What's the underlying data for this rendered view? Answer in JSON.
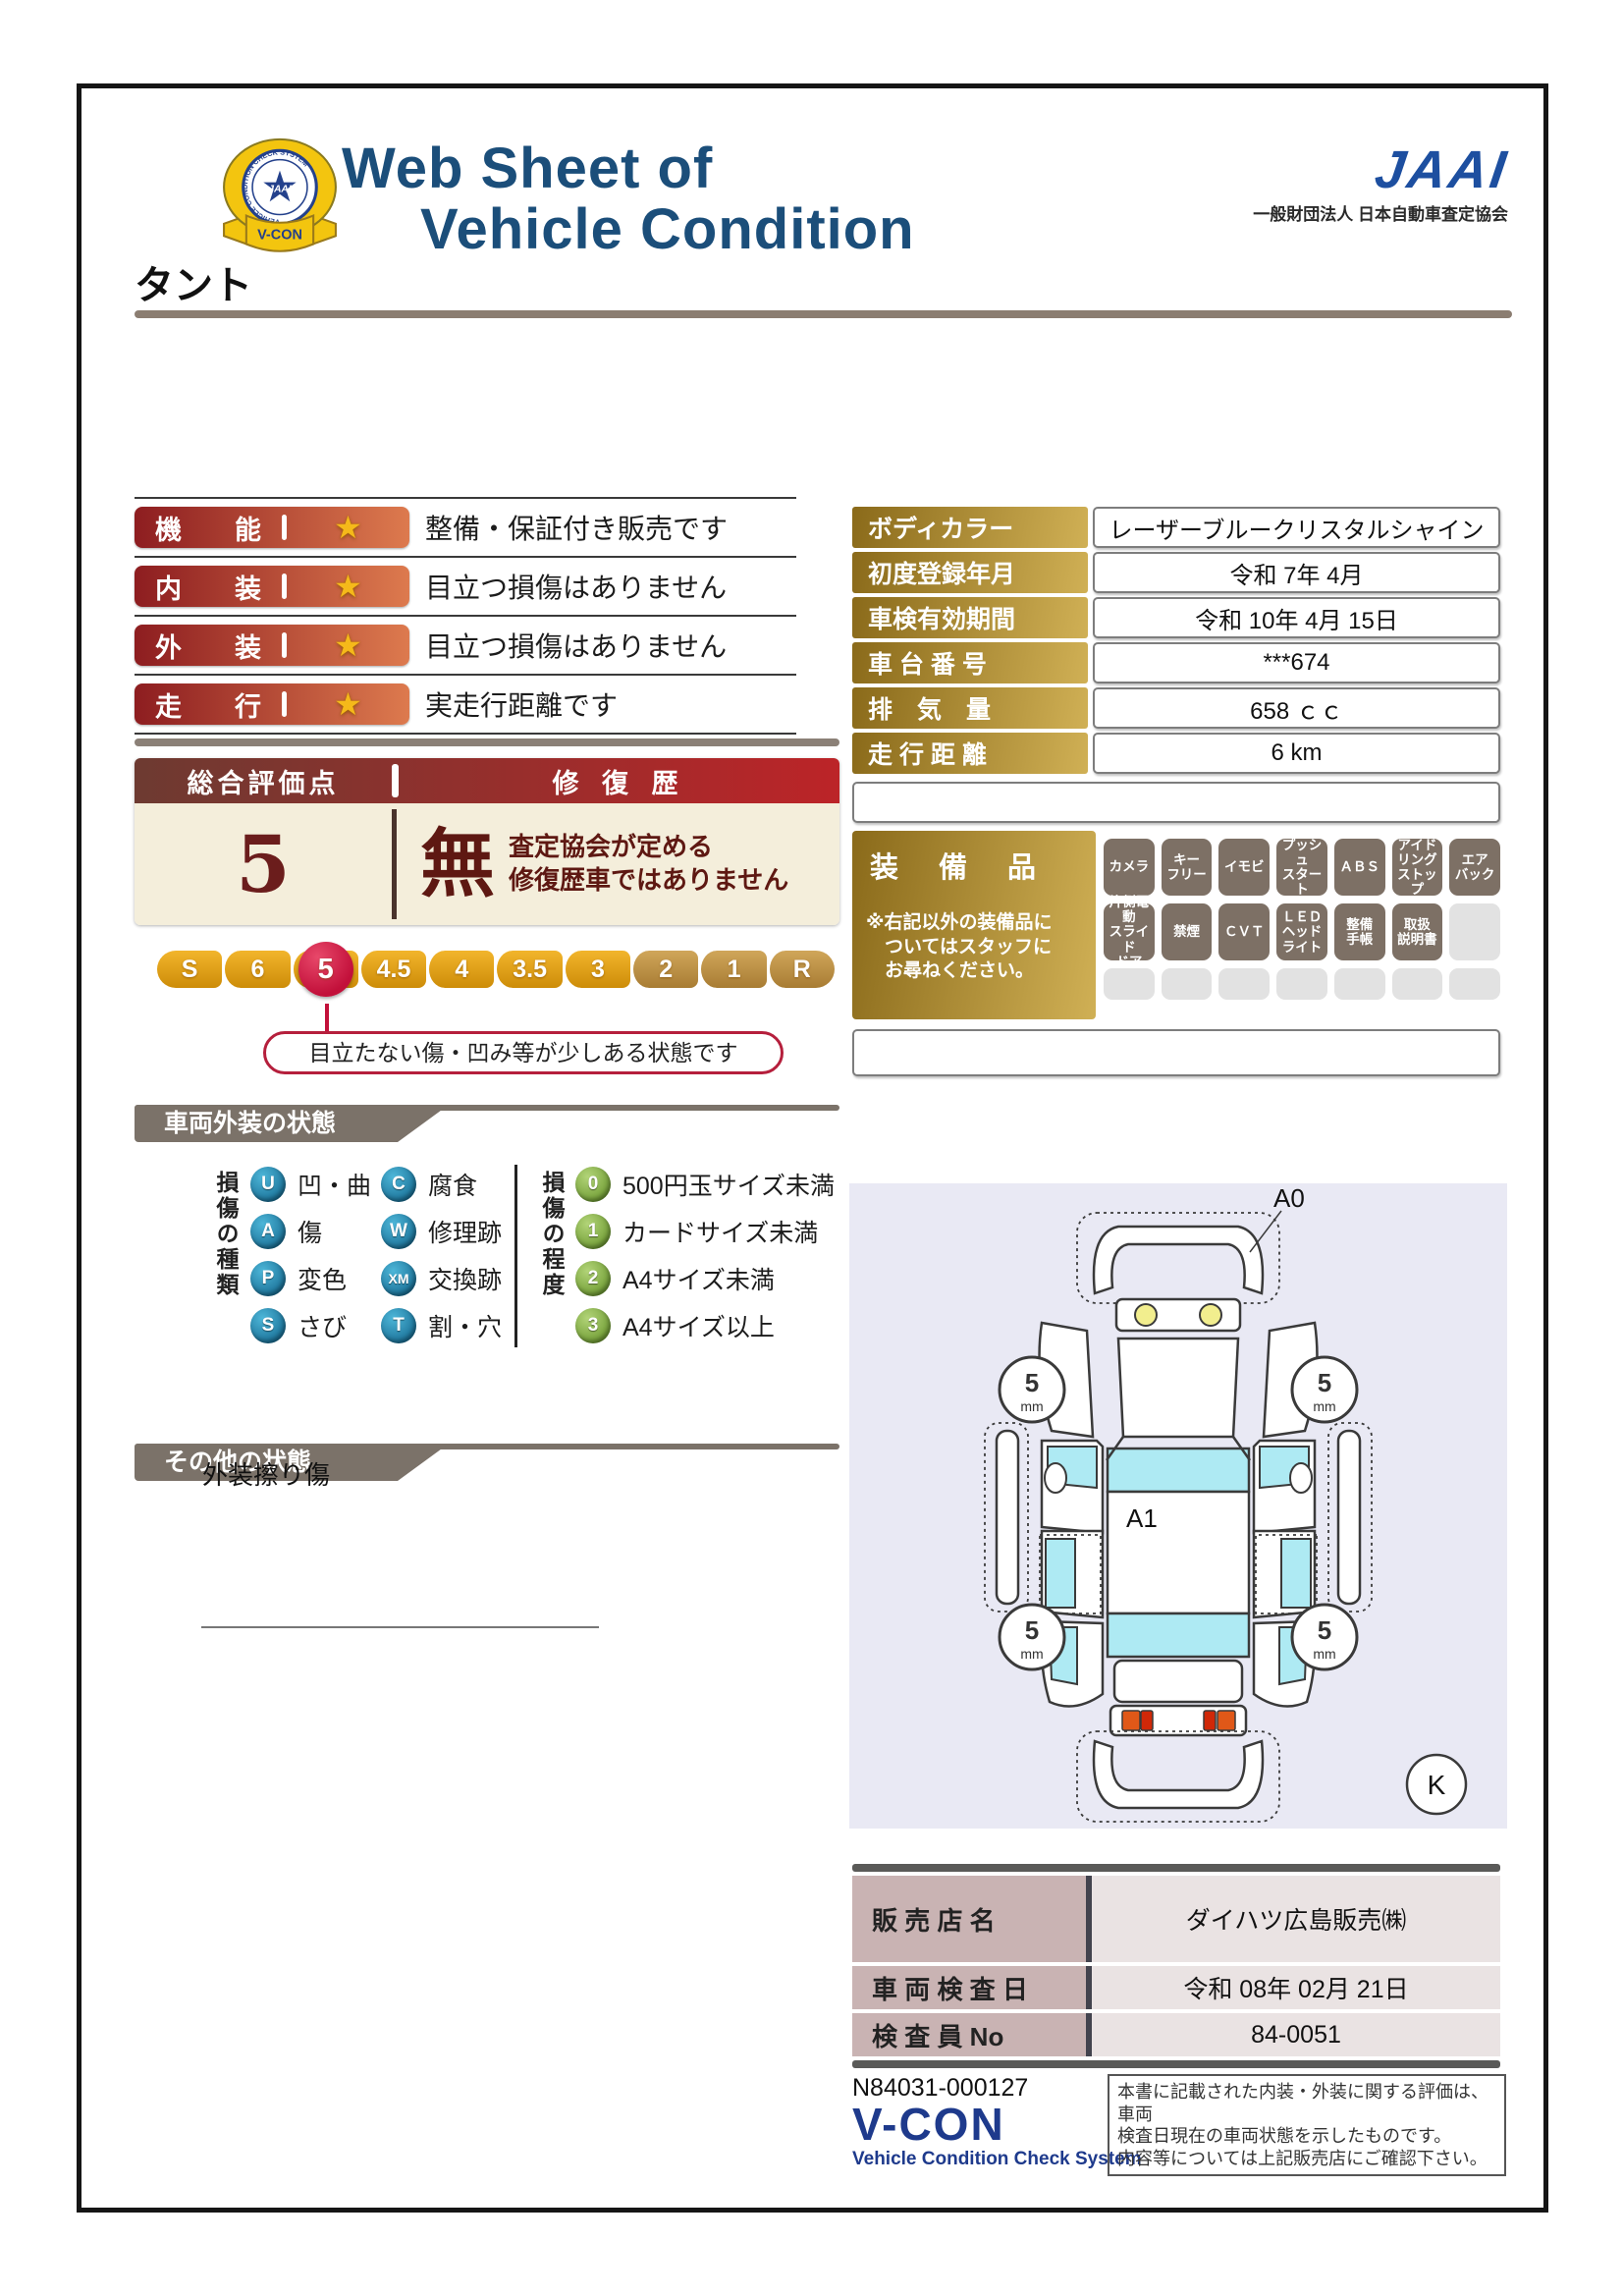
{
  "header": {
    "title_line1": "Web Sheet of",
    "title_line2": "Vehicle Condition",
    "badge": {
      "jaai": "JAAI",
      "ring_text": "VEHICLE CONDITION CHECK SYSTEM",
      "ribbon": "V-CON"
    },
    "jaai_wordmark": "JAAI",
    "jaai_org": "一般財団法人 日本自動車査定協会"
  },
  "vehicle_name": "タント",
  "ratings": [
    {
      "label": "機　　能",
      "stars": 1,
      "desc": "整備・保証付き販売です"
    },
    {
      "label": "内　　装",
      "stars": 1,
      "desc": "目立つ損傷はありません"
    },
    {
      "label": "外　　装",
      "stars": 1,
      "desc": "目立つ損傷はありません"
    },
    {
      "label": "走　　行",
      "stars": 1,
      "desc": "実走行距離です"
    }
  ],
  "overall": {
    "score_label": "総合評価点",
    "repair_label": "修 復 歴",
    "score": "5",
    "repair_status": "無",
    "repair_note": "査定協会が定める\n修復歴車ではありません"
  },
  "scale": {
    "values": [
      "S",
      "6",
      "5",
      "4.5",
      "4",
      "3.5",
      "3",
      "2",
      "1",
      "R"
    ],
    "selected": "5",
    "callout": "目立たない傷・凹み等が少しある状態です"
  },
  "details": {
    "rows": [
      {
        "label": "ボディカラー",
        "value": "レーザーブルークリスタルシャイン"
      },
      {
        "label": "初度登録年月",
        "value": "令和 7年 4月"
      },
      {
        "label": "車検有効期間",
        "value": "令和 10年 4月 15日"
      },
      {
        "label": "車 台 番 号",
        "value": "***674"
      },
      {
        "label": "排　気　量",
        "value": "658 ｃｃ"
      },
      {
        "label": "走 行 距 離",
        "value": "6 km"
      }
    ]
  },
  "equipment": {
    "title": "装　備　品",
    "note": "※右記以外の装備品に\n　ついてはスタッフに\n　お尋ねください。",
    "rows": [
      [
        "カメラ",
        "キー\nフリー",
        "イモビ",
        "プッシュ\nスタート",
        "ＡＢＳ",
        "アイド\nリング\nストップ",
        "エア\nバック"
      ],
      [
        "片側電動\nスライド\nドア",
        "禁煙",
        "ＣＶＴ",
        "ＬＥＤ\nヘッド\nライト",
        "整備\n手帳",
        "取扱\n説明書",
        ""
      ],
      [
        "",
        "",
        "",
        "",
        "",
        "",
        ""
      ]
    ]
  },
  "exterior_section": {
    "title": "車両外装の状態",
    "kind_label": "損傷の種類",
    "kinds": [
      {
        "code": "U",
        "label": "凹・曲"
      },
      {
        "code": "A",
        "label": "傷"
      },
      {
        "code": "P",
        "label": "変色"
      },
      {
        "code": "S",
        "label": "さび"
      },
      {
        "code": "C",
        "label": "腐食"
      },
      {
        "code": "W",
        "label": "修理跡"
      },
      {
        "code": "XM",
        "label": "交換跡"
      },
      {
        "code": "T",
        "label": "割・穴"
      }
    ],
    "degree_label": "損傷の程度",
    "degrees": [
      {
        "code": "0",
        "label": "500円玉サイズ未満"
      },
      {
        "code": "1",
        "label": "カードサイズ未満"
      },
      {
        "code": "2",
        "label": "A4サイズ未満"
      },
      {
        "code": "3",
        "label": "A4サイズ以上"
      }
    ]
  },
  "diagram": {
    "marker_a0": "A0",
    "marker_a1": "A1",
    "tread_value": "5",
    "tread_unit": "mm",
    "corner_mark": "K"
  },
  "other_section": {
    "title": "その他の状態",
    "note": "外装擦り傷"
  },
  "dealer": {
    "rows": [
      {
        "label": "販 売 店 名",
        "value": "ダイハツ広島販売㈱"
      },
      {
        "label": "車 両 検 査 日",
        "value": "令和 08年 02月 21日"
      },
      {
        "label": "検 査 員 No",
        "value": "84-0051"
      }
    ]
  },
  "footer": {
    "sheet_number": "N84031-000127",
    "vcon": "V-CON",
    "vcon_sub": "Vehicle Condition Check System",
    "note": "本書に記載された内装・外装に関する評価は、車両\n検査日現在の車両状態を示したものです。\n内容等については上記販売店にご確認下さい。"
  }
}
